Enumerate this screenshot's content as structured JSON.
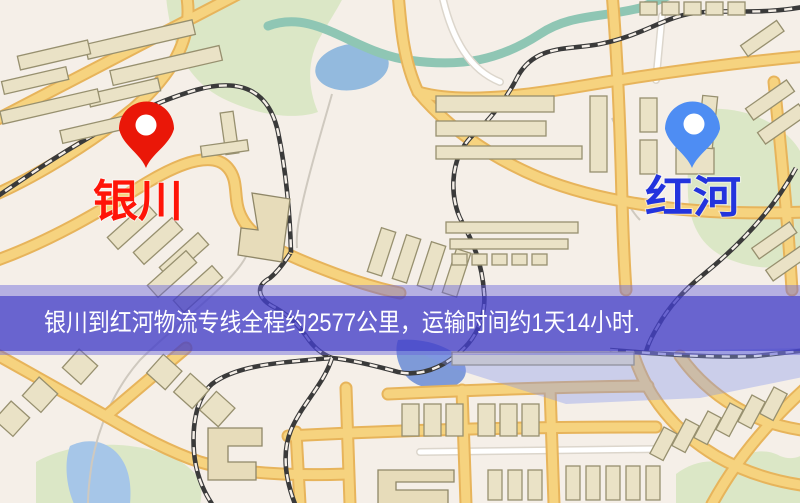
{
  "map": {
    "pins": {
      "origin": {
        "label": "银川",
        "pin_color": "#ea1708",
        "label_color": "#ff1408"
      },
      "destination": {
        "label": "红河",
        "pin_color": "#4e8df3",
        "label_color": "#2334de"
      }
    },
    "banner": {
      "text": "银川到红河物流专线全程约2577公里，运输时间约1天14小时.",
      "origin": "银川",
      "destination": "红河",
      "distance_text": "约2577公里",
      "duration_text": "约1天14小时",
      "band_color": "#5f5cc8"
    },
    "legend_colors": {
      "road": "#f6d37f",
      "park": "#dbe7c6",
      "water": "#93bade",
      "building": "#eae2c6"
    }
  }
}
